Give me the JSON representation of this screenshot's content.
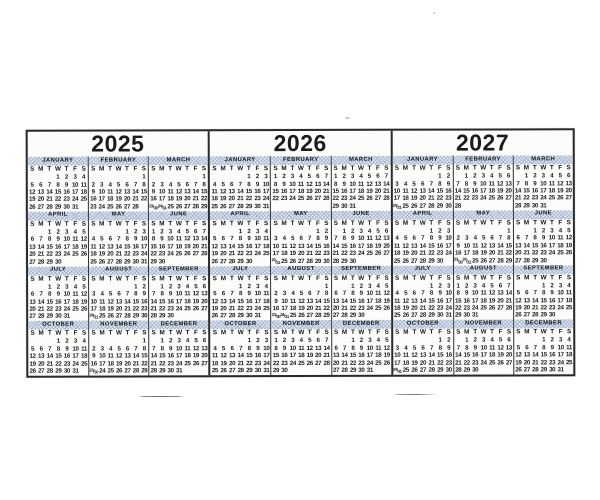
{
  "page": {
    "background": "#ffffff"
  },
  "calendar": {
    "border_color": "#2a2a2a",
    "hatch_color": "#c7d2e3",
    "weekday_header": "S M T W T F S",
    "years": [
      {
        "label": "2025",
        "months": [
          {
            "name": "JANUARY",
            "rows": [
              ". . . 1 2 3 4",
              "5 6 7 8 9 10 11",
              "12 13 14 15 16 17 18",
              "19 20 21 22 23 24 25",
              "26 27 28 29 30 31 ."
            ]
          },
          {
            "name": "FEBRUARY",
            "rows": [
              ". . . . . . 1",
              "2 3 4 5 6 7 8",
              "9 10 11 12 13 14 15",
              "16 17 18 19 20 21 22",
              "23 24 25 26 27 28 ."
            ]
          },
          {
            "name": "MARCH",
            "rows": [
              ". . . . . . 1",
              "2 3 4 5 6 7 8",
              "9 10 11 12 13 14 15",
              "16 17 18 19 20 21 22",
              "23/30 24/31 25 26 27 28 29"
            ]
          },
          {
            "name": "APRIL",
            "rows": [
              ". . 1 2 3 4 5",
              "6 7 8 9 10 11 12",
              "13 14 15 16 17 18 19",
              "20 21 22 23 24 25 26",
              "27 28 29 30 . . ."
            ]
          },
          {
            "name": "MAY",
            "rows": [
              ". . . . 1 2 3",
              "4 5 6 7 8 9 10",
              "11 12 13 14 15 16 17",
              "18 19 20 21 22 23 24",
              "25 26 27 28 29 30 31"
            ]
          },
          {
            "name": "JUNE",
            "rows": [
              "1 2 3 4 5 6 7",
              "8 9 10 11 12 13 14",
              "15 16 17 18 19 20 21",
              "22 23 24 25 26 27 28",
              "29 30 . . . . ."
            ]
          },
          {
            "name": "JULY",
            "rows": [
              ". . 1 2 3 4 5",
              "6 7 8 9 10 11 12",
              "13 14 15 16 17 18 19",
              "20 21 22 23 24 25 26",
              "27 28 29 30 31 . ."
            ]
          },
          {
            "name": "AUGUST",
            "rows": [
              ". . . . . 1 2",
              "3 4 5 6 7 8 9",
              "10 11 12 13 14 15 16",
              "17 18 19 20 21 22 23",
              "24/31 25 26 27 28 29 30"
            ]
          },
          {
            "name": "SEPTEMBER",
            "rows": [
              ". 1 2 3 4 5 6",
              "7 8 9 10 11 12 13",
              "14 15 16 17 18 19 20",
              "21 22 23 24 25 26 27",
              "28 29 30 . . . ."
            ]
          },
          {
            "name": "OCTOBER",
            "rows": [
              ". . . 1 2 3 4",
              "5 6 7 8 9 10 11",
              "12 13 14 15 16 17 18",
              "19 20 21 22 23 24 25",
              "26 27 28 29 30 31 ."
            ]
          },
          {
            "name": "NOVEMBER",
            "rows": [
              ". . . . . . 1",
              "2 3 4 5 6 7 8",
              "9 10 11 12 13 14 15",
              "16 17 18 19 20 21 22",
              "23/30 24 25 26 27 28 29"
            ]
          },
          {
            "name": "DECEMBER",
            "rows": [
              ". 1 2 3 4 5 6",
              "7 8 9 10 11 12 13",
              "14 15 16 17 18 19 20",
              "21 22 23 24 25 26 27",
              "28 29 30 31 . . ."
            ]
          }
        ]
      },
      {
        "label": "2026",
        "months": [
          {
            "name": "JANUARY",
            "rows": [
              ". . . . 1 2 3",
              "4 5 6 7 8 9 10",
              "11 12 13 14 15 16 17",
              "18 19 20 21 22 23 24",
              "25 26 27 28 29 30 31"
            ]
          },
          {
            "name": "FEBRUARY",
            "rows": [
              "1 2 3 4 5 6 7",
              "8 9 10 11 12 13 14",
              "15 16 17 18 19 20 21",
              "22 23 24 25 26 27 28",
              ". . . . . . ."
            ]
          },
          {
            "name": "MARCH",
            "rows": [
              "1 2 3 4 5 6 7",
              "8 9 10 11 12 13 14",
              "15 16 17 18 19 20 21",
              "22 23 24 25 26 27 28",
              "29 30 31 . . . ."
            ]
          },
          {
            "name": "APRIL",
            "rows": [
              ". . . 1 2 3 4",
              "5 6 7 8 9 10 11",
              "12 13 14 15 16 17 18",
              "19 20 21 22 23 24 25",
              "26 27 28 29 30 . ."
            ]
          },
          {
            "name": "MAY",
            "rows": [
              ". . . . . 1 2",
              "3 4 5 6 7 8 9",
              "10 11 12 13 14 15 16",
              "17 18 19 20 21 22 23",
              "24/31 25 26 27 28 29 30"
            ]
          },
          {
            "name": "JUNE",
            "rows": [
              ". 1 2 3 4 5 6",
              "7 8 9 10 11 12 13",
              "14 15 16 17 18 19 20",
              "21 22 23 24 25 26 27",
              "28 29 30 . . . ."
            ]
          },
          {
            "name": "JULY",
            "rows": [
              ". . . 1 2 3 4",
              "5 6 7 8 9 10 11",
              "12 13 14 15 16 17 18",
              "19 20 21 22 23 24 25",
              "26 27 28 29 30 31 ."
            ]
          },
          {
            "name": "AUGUST",
            "rows": [
              ". . . . . . 1",
              "2 3 4 5 6 7 8",
              "9 10 11 12 13 14 15",
              "16 17 18 19 20 21 22",
              "23/30 24/31 25 26 27 28 29"
            ]
          },
          {
            "name": "SEPTEMBER",
            "rows": [
              ". . 1 2 3 4 5",
              "6 7 8 9 10 11 12",
              "13 14 15 16 17 18 19",
              "20 21 22 23 24 25 26",
              "27 28 29 30 . . ."
            ]
          },
          {
            "name": "OCTOBER",
            "rows": [
              ". . . . 1 2 3",
              "4 5 6 7 8 9 10",
              "11 12 13 14 15 16 17",
              "18 19 20 21 22 23 24",
              "25 26 27 28 29 30 31"
            ]
          },
          {
            "name": "NOVEMBER",
            "rows": [
              "1 2 3 4 5 6 7",
              "8 9 10 11 12 13 14",
              "15 16 17 18 19 20 21",
              "22 23 24 25 26 27 28",
              "29 30 . . . . ."
            ]
          },
          {
            "name": "DECEMBER",
            "rows": [
              ". . 1 2 3 4 5",
              "6 7 8 9 10 11 12",
              "13 14 15 16 17 18 19",
              "20 21 22 23 24 25 26",
              "27 28 29 30 31 . ."
            ]
          }
        ]
      },
      {
        "label": "2027",
        "months": [
          {
            "name": "JANUARY",
            "rows": [
              ". . . . . 1 2",
              "3 4 5 6 7 8 9",
              "10 11 12 13 14 15 16",
              "17 18 19 20 21 22 23",
              "24/31 25 26 27 28 29 30"
            ]
          },
          {
            "name": "FEBRUARY",
            "rows": [
              ". 1 2 3 4 5 6",
              "7 8 9 10 11 12 13",
              "14 15 16 17 18 19 20",
              "21 22 23 24 25 26 27",
              "28 . . . . . ."
            ]
          },
          {
            "name": "MARCH",
            "rows": [
              ". 1 2 3 4 5 6",
              "7 8 9 10 11 12 13",
              "14 15 16 17 18 19 20",
              "21 22 23 24 25 26 27",
              "28 29 30 31 . . ."
            ]
          },
          {
            "name": "APRIL",
            "rows": [
              ". . . . 1 2 3",
              "4 5 6 7 8 9 10",
              "11 12 13 14 15 16 17",
              "18 19 20 21 22 23 24",
              "25 26 27 28 29 30 ."
            ]
          },
          {
            "name": "MAY",
            "rows": [
              ". . . . . . 1",
              "2 3 4 5 6 7 8",
              "9 10 11 12 13 14 15",
              "16 17 18 19 20 21 22",
              "23/30 24/31 25 26 27 28 29"
            ]
          },
          {
            "name": "JUNE",
            "rows": [
              ". . 1 2 3 4 5",
              "6 7 8 9 10 11 12",
              "13 14 15 16 17 18 19",
              "20 21 22 23 24 25 26",
              "27 28 29 30 . . ."
            ]
          },
          {
            "name": "JULY",
            "rows": [
              ". . . . 1 2 3",
              "4 5 6 7 8 9 10",
              "11 12 13 14 15 16 17",
              "18 19 20 21 22 23 24",
              "25 26 27 28 29 30 31"
            ]
          },
          {
            "name": "AUGUST",
            "rows": [
              "1 2 3 4 5 6 7",
              "8 9 10 11 12 13 14",
              "15 16 17 18 19 20 21",
              "22 23 24 25 26 27 28",
              "29 30 31 . . . ."
            ]
          },
          {
            "name": "SEPTEMBER",
            "rows": [
              ". . . 1 2 3 4",
              "5 6 7 8 9 10 11",
              "12 13 14 15 16 17 18",
              "19 20 21 22 23 24 25",
              "26 27 28 29 30 . ."
            ]
          },
          {
            "name": "OCTOBER",
            "rows": [
              ". . . . . 1 2",
              "3 4 5 6 7 8 9",
              "10 11 12 13 14 15 16",
              "17 18 19 20 21 22 23",
              "24/31 25 26 27 28 29 30"
            ]
          },
          {
            "name": "NOVEMBER",
            "rows": [
              ". 1 2 3 4 5 6",
              "7 8 9 10 11 12 13",
              "14 15 16 17 18 19 20",
              "21 22 23 24 25 26 27",
              "28 29 30 . . . ."
            ]
          },
          {
            "name": "DECEMBER",
            "rows": [
              ". . . 1 2 3 4",
              "5 6 7 8 9 10 11",
              "12 13 14 15 16 17 18",
              "19 20 21 22 23 24 25",
              "26 27 28 29 30 31 ."
            ]
          }
        ]
      }
    ]
  }
}
